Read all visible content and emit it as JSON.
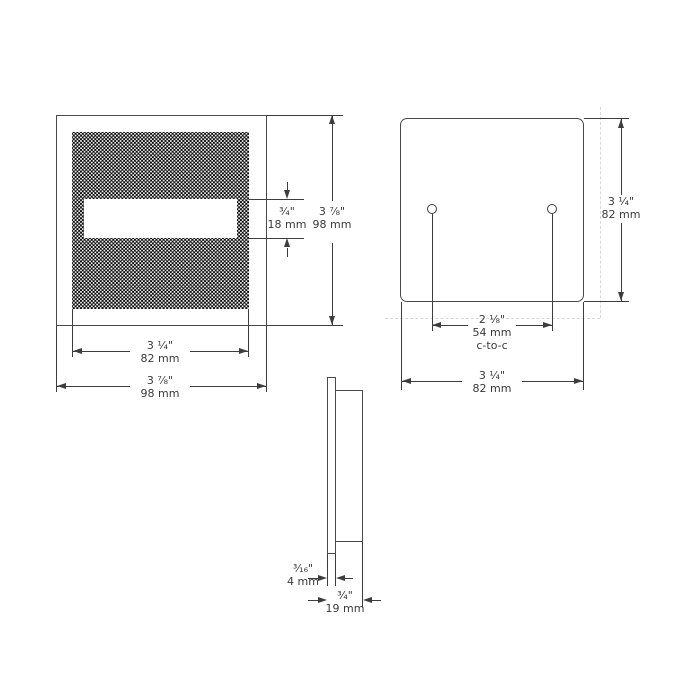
{
  "drawing": {
    "kind": "product dimension drawing",
    "views": [
      "front",
      "back",
      "side"
    ]
  },
  "colors": {
    "line": "#3d3d3d",
    "text": "#3a3a3a",
    "mesh": "#060606",
    "dash": "#d8d8d8"
  },
  "front_view": {
    "slot_height": {
      "in": "³⁄₄\"",
      "mm": "18 mm"
    },
    "overall_height": {
      "in": "3 ⁷⁄₈\"",
      "mm": "98 mm"
    },
    "grille_width": {
      "in": "3 ¹⁄₄\"",
      "mm": "82 mm"
    },
    "overall_width": {
      "in": "3 ⁷⁄₈\"",
      "mm": "98 mm"
    }
  },
  "back_view": {
    "plate_height": {
      "in": "3 ¹⁄₄\"",
      "mm": "82 mm"
    },
    "hole_spacing": {
      "in": "2 ¹⁄₈\"",
      "mm": "54 mm",
      "note": "c-to-c"
    },
    "plate_width": {
      "in": "3 ¹⁄₄\"",
      "mm": "82 mm"
    }
  },
  "side_view": {
    "flange_thickness": {
      "in": "³⁄₁₆\"",
      "mm": "4 mm"
    },
    "overall_depth": {
      "in": "³⁄₄\"",
      "mm": "19 mm"
    }
  }
}
